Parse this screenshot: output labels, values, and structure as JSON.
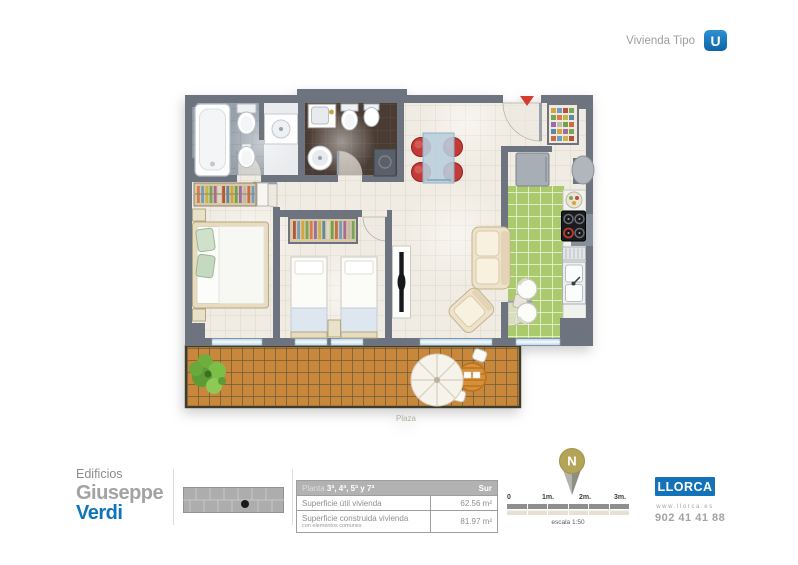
{
  "header": {
    "label": "Vivienda Tipo",
    "badge_letter": "U",
    "badge_color": "#1277bd"
  },
  "plan": {
    "caption": "Plaza"
  },
  "brand": {
    "line1": "Edificios",
    "line2": "Giuseppe",
    "line3": "Verdi",
    "accent_color": "#0f75bb"
  },
  "spec_table": {
    "header_light": "Planta",
    "header_bold": "3ª, 4ª, 5ª y 7ª",
    "header_right": "Sur",
    "rows": [
      {
        "label": "Superficie útil vivienda",
        "note": "",
        "value": "62.56 m²"
      },
      {
        "label": "Superficie construida vivienda",
        "note": "con elementos comunes",
        "value": "81.97 m²"
      }
    ]
  },
  "scale_bar": {
    "ticks": [
      "0",
      "1m.",
      "2m.",
      "3m."
    ],
    "caption": "escala 1:50"
  },
  "compass": {
    "letter": "N"
  },
  "publisher": {
    "name": "LLORCA",
    "website": "www.llorca.es",
    "phone": "902 41 41 88"
  }
}
